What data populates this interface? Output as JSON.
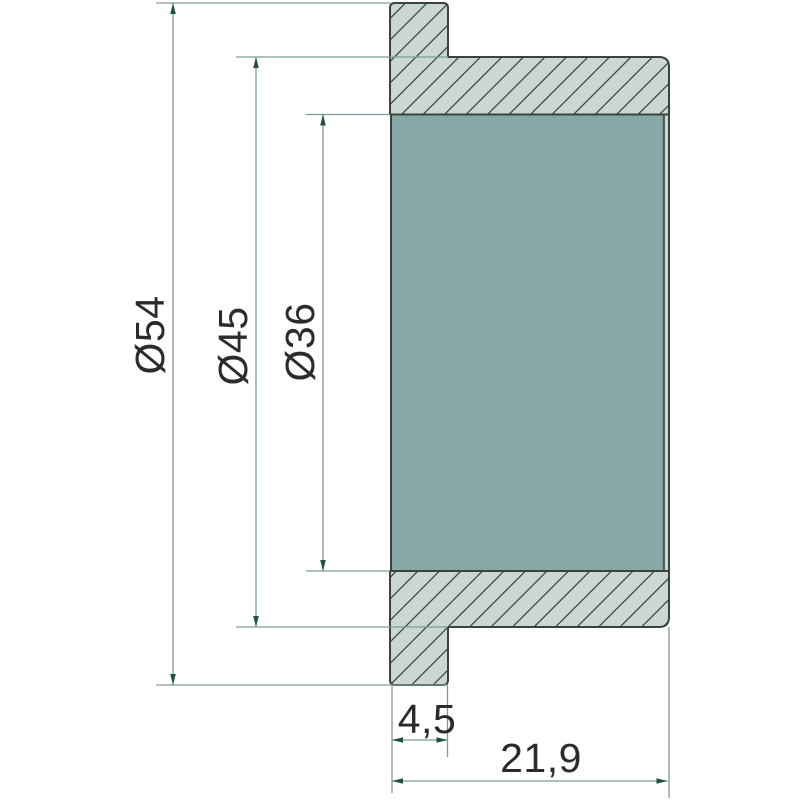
{
  "drawing": {
    "type": "technical-drawing-cross-section",
    "dimensions": {
      "flange_diameter": {
        "label": "Ø54",
        "value": 54
      },
      "body_diameter": {
        "label": "Ø45",
        "value": 45
      },
      "bore_diameter": {
        "label": "Ø36",
        "value": 36
      },
      "flange_thickness": {
        "label": "4,5",
        "value": 4.5
      },
      "overall_length": {
        "label": "21,9",
        "value": 21.9
      }
    },
    "colors": {
      "background": "#ffffff",
      "section_fill": "#ccd6d2",
      "hatch_line": "#3c4844",
      "outline": "#3a433f",
      "bore_fill": "#87a9a6",
      "bore_edge": "#3e5d54",
      "dimension_line": "#7d9c94",
      "arrow": "#1f5242",
      "text": "#2b2b2b"
    }
  }
}
